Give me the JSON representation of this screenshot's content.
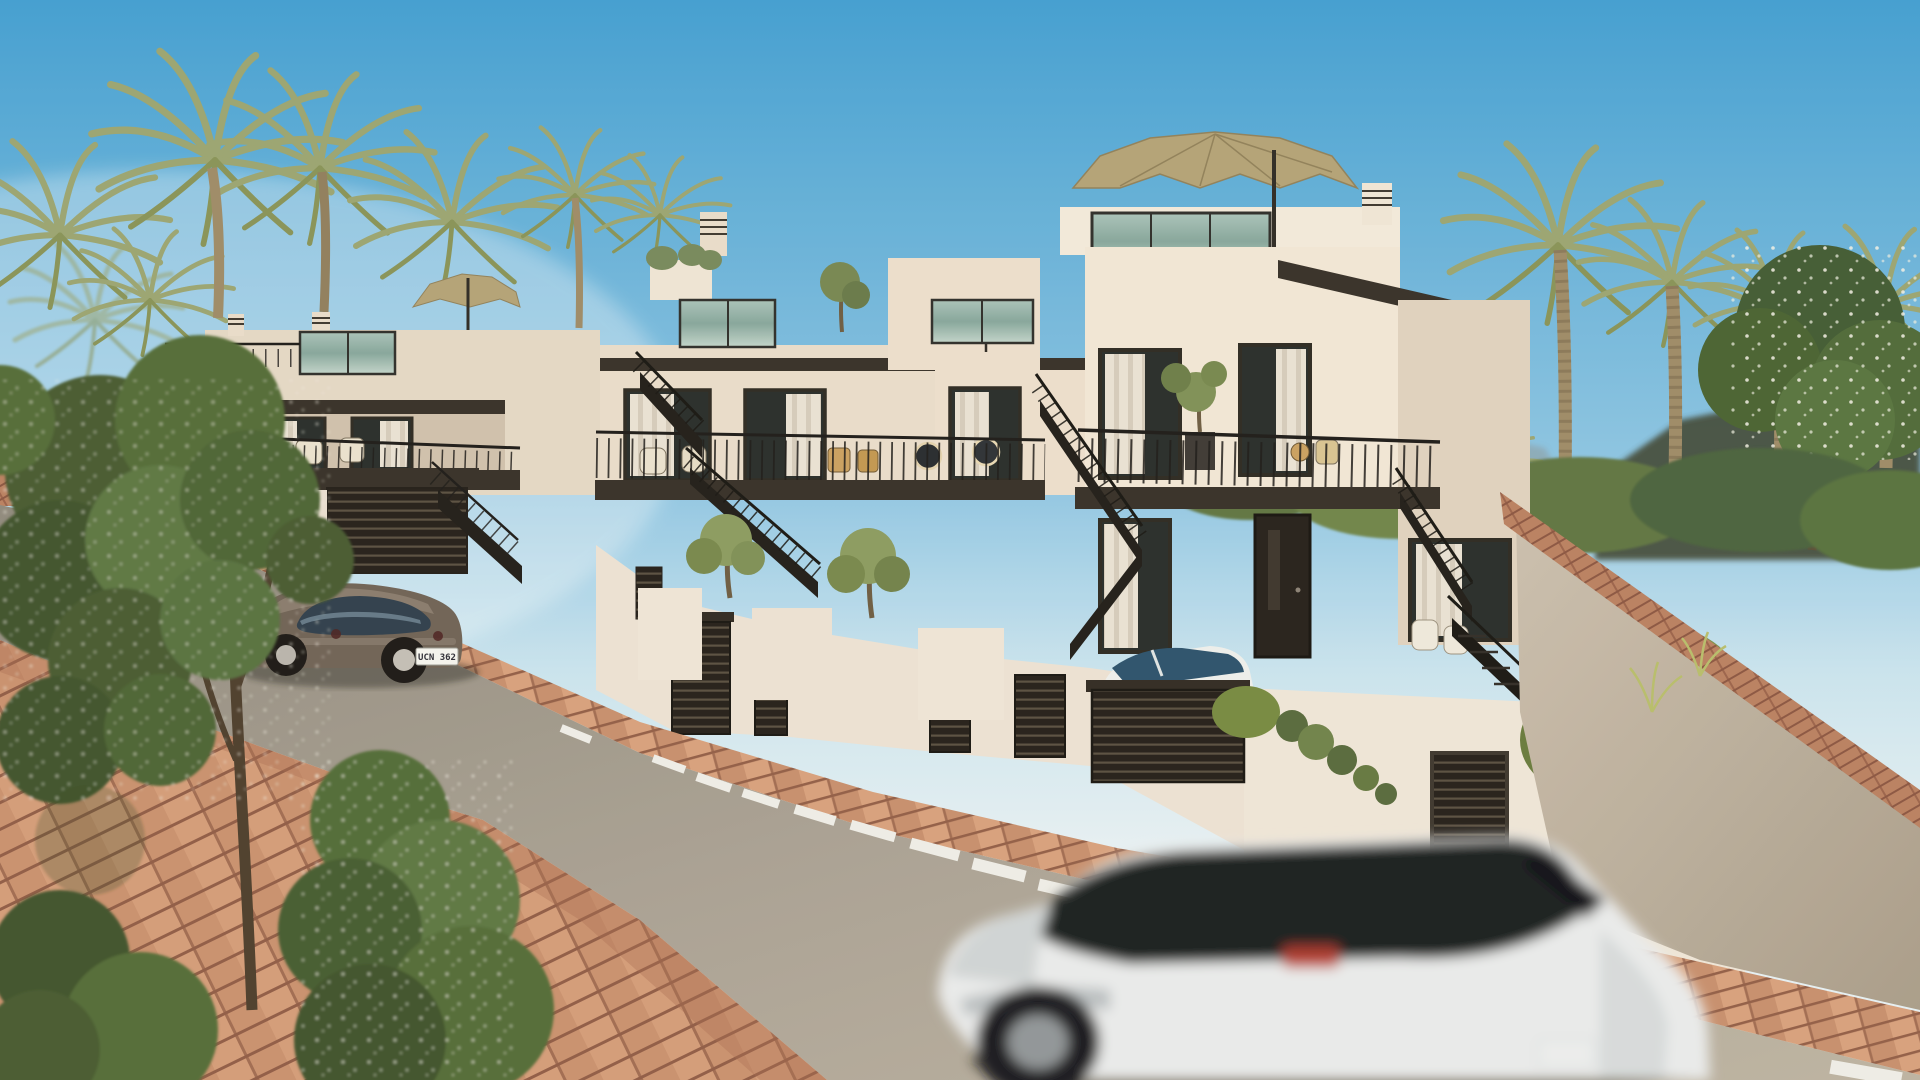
{
  "scene": {
    "description": "Photorealistic architectural rendering of a terraced row of four modern cream townhouses on a sloping Mediterranean street, daytime, clear blue sky",
    "sky": "clear blue gradient with light haze at left horizon",
    "background": "date palms, leafy trees, dark distant hills on the right"
  },
  "palette": {
    "sky_top": "#3f9ed2",
    "sky_horizon": "#e6f1f5",
    "facade_light": "#f2e7d6",
    "facade_shade": "#d9cbb6",
    "fascia_dark": "#332d25",
    "terrace_glass": "#84a59b",
    "window_glass": "#242a28",
    "curtain_white": "#e9e2d4",
    "railing_black": "#1a1816",
    "garage_slat": "#211c17",
    "umbrella_tan": "#b3a275",
    "hedge_green": "#6d8140",
    "palm_green": "#99a470",
    "brick_terracotta": "#c9906d",
    "road_asphalt": "#a49d8f",
    "parked_car_bronze": "#6d6054",
    "suv_white": "#e9ebec",
    "taillight_red": "#c0392b"
  },
  "buildings": {
    "count": 4,
    "features": [
      "rooftop terraces with teal glass balustrades",
      "tan patio parasols",
      "black steel exterior staircases",
      "balconies with black metal railings and wicker chairs",
      "dark slatted garage doors and gates",
      "floor-to-ceiling windows with white curtains",
      "white street walls with planters and hedges"
    ]
  },
  "street": {
    "lane_marking": "dashed white center line",
    "paving": "terracotta brick sidewalks and driveway ramp"
  },
  "vehicles": {
    "parked_car": {
      "description": "bronze compact car parked at the curb",
      "license_plate": "UCN 362"
    },
    "driveway_car": {
      "description": "white car parked behind dark slatted driveway gate"
    },
    "moving_suv": {
      "description": "white SUV driving down the street, motion blurred",
      "license_plate": ""
    }
  },
  "vegetation": [
    "date palms",
    "leafy foreground trees",
    "clipped hedges",
    "white flowering shrubs",
    "ornamental grasses",
    "ivy spilling over wall"
  ]
}
